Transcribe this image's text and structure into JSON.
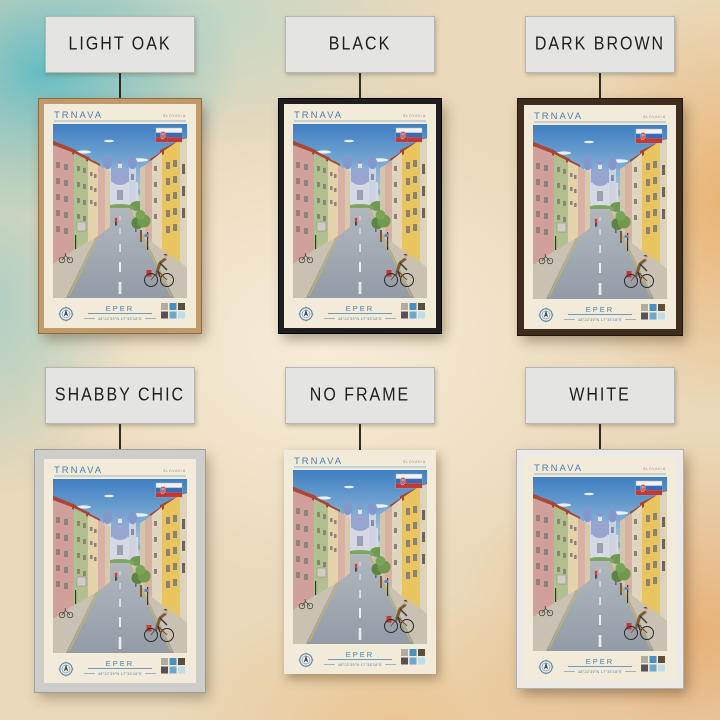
{
  "product": {
    "subject": "Trnava travel poster",
    "rows": 2,
    "columns": 3
  },
  "variants": [
    {
      "label": "LIGHT OAK",
      "frame_color": "#c09a6a"
    },
    {
      "label": "BLACK",
      "frame_color": "#201e1c"
    },
    {
      "label": "DARK BROWN",
      "frame_color": "#3e2c1e"
    },
    {
      "label": "SHABBY CHIC",
      "frame_color": "#cdcdcb"
    },
    {
      "label": "NO FRAME",
      "frame_color": ""
    },
    {
      "label": "WHITE",
      "frame_color": "#eceae7"
    }
  ],
  "poster": {
    "title": "TRNAVA",
    "country": "SLOVAKIA",
    "subtitle": "EPER",
    "coordinates": "48°22'39\"N 17°35'18\"E",
    "flag": "slovakia-flag",
    "accent_color": "#4a7fae",
    "paper_color": "#f2ebda",
    "palette": [
      "#b3ab9b",
      "#4a8fc4",
      "#5d4f38",
      "#5a4e57",
      "#6fa8cc",
      "#c2dbe4"
    ]
  }
}
